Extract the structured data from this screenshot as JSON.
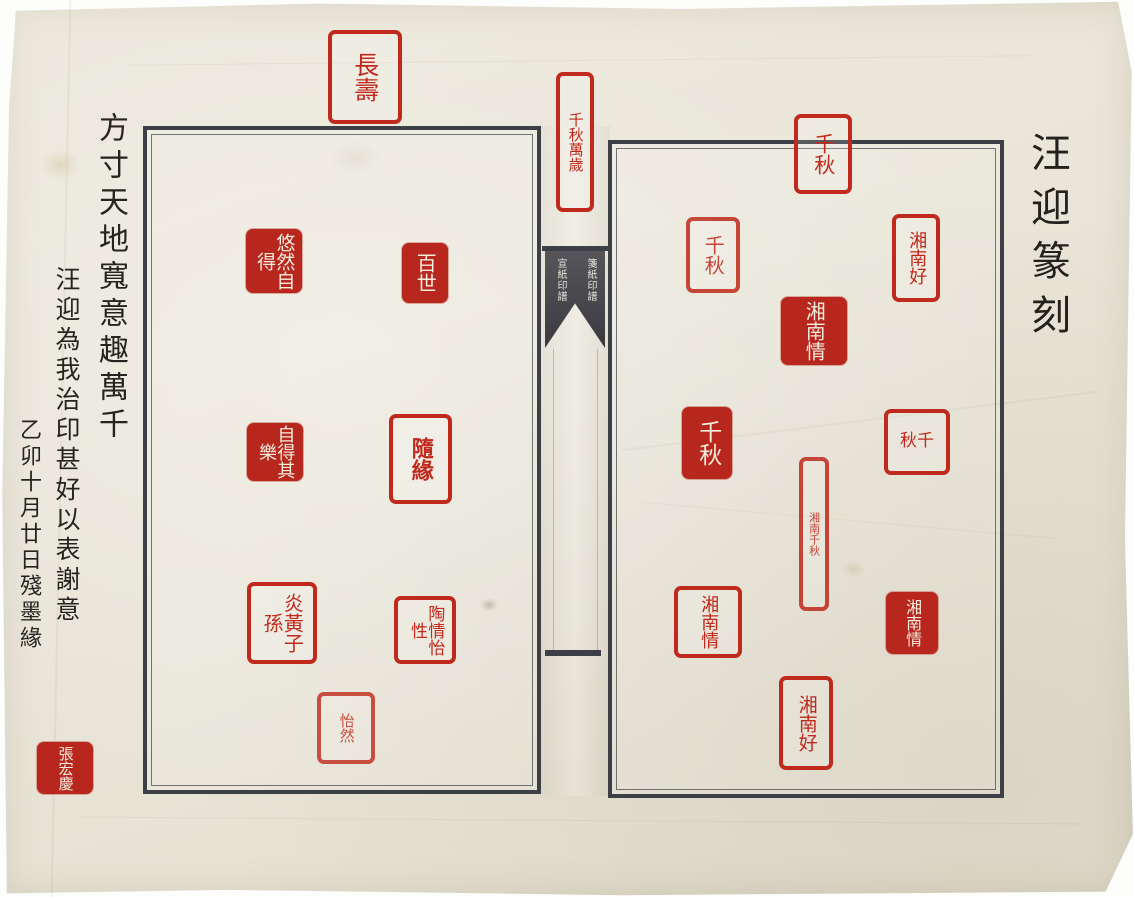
{
  "artifact": {
    "kind": "photograph of a Chinese seal-impression album (yinpu), two facing pages with red seal stamps and ink calligraphy margins"
  },
  "right_margin": {
    "title": "汪迎篆刻"
  },
  "left_margin": {
    "columns": [
      {
        "text": "方寸天地寬意趣萬千"
      },
      {
        "text": "汪迎為我治印甚好以表謝意"
      },
      {
        "text": "乙卯十月廿日殘墨緣"
      }
    ],
    "signature_seal": {
      "text": "張宏慶",
      "style": "intaglio"
    }
  },
  "top_seal": {
    "text": "長壽",
    "style": "relief"
  },
  "spine": {
    "top_seal": {
      "text": "千秋萬歲",
      "style": "relief"
    },
    "fishtail_label": {
      "columns": [
        "箋紙印譜",
        "宣紙印譜"
      ]
    }
  },
  "left_page": {
    "seals": [
      {
        "text": "悠然自得",
        "style": "intaglio"
      },
      {
        "text": "百世",
        "style": "intaglio"
      },
      {
        "text": "自得其樂",
        "style": "intaglio"
      },
      {
        "text": "隨緣",
        "style": "relief"
      },
      {
        "text": "炎黃子孫",
        "style": "relief"
      },
      {
        "text": "陶情怡性",
        "style": "relief"
      },
      {
        "text": "怡然",
        "style": "relief"
      }
    ]
  },
  "right_page": {
    "seals": [
      {
        "text": "千秋",
        "style": "relief"
      },
      {
        "text": "千秋",
        "style": "relief"
      },
      {
        "text": "湘南好",
        "style": "relief"
      },
      {
        "text": "湘南情",
        "style": "intaglio"
      },
      {
        "text": "千秋",
        "style": "intaglio"
      },
      {
        "text": "秋千",
        "style": "relief"
      },
      {
        "text": "湘南千秋",
        "style": "relief"
      },
      {
        "text": "湘南情",
        "style": "relief"
      },
      {
        "text": "湘南情",
        "style": "intaglio"
      },
      {
        "text": "湘南好",
        "style": "relief"
      }
    ]
  },
  "colors": {
    "seal_red": "#bf2a1d",
    "intaglio_red": "#b7271d",
    "ink": "#26241f",
    "paper": "#e9e5d8",
    "frame": "#3c4046",
    "fishtail_bg": "#434347"
  }
}
